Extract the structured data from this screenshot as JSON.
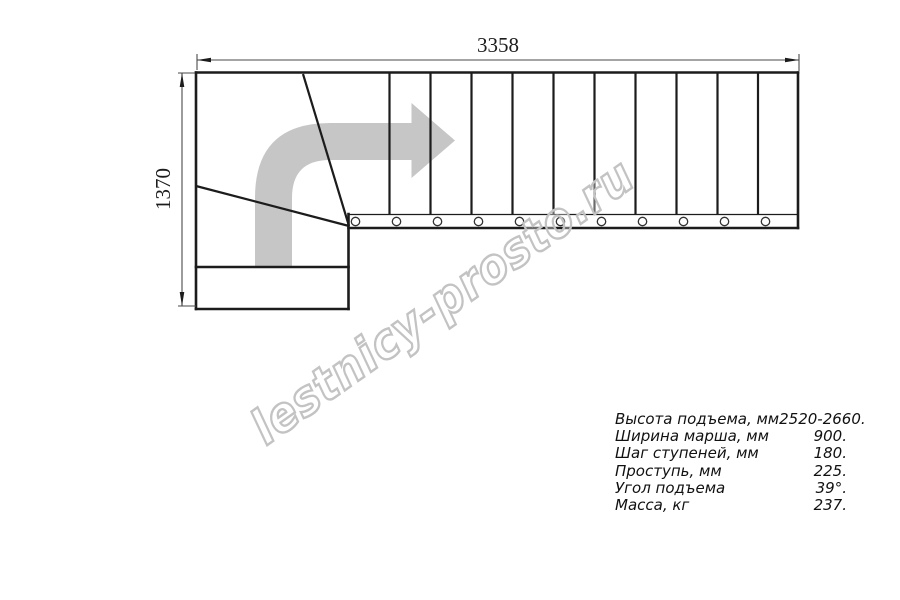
{
  "drawing": {
    "title": "stair plan top view",
    "width_dimension_mm": "3358",
    "height_dimension_mm": "1370",
    "straight_treads_count": 11,
    "mount_holes_count": 11,
    "colors": {
      "line": "#1c1c1c",
      "dimension_line": "#4a4a4a",
      "direction_arrow": "#c6c6c6",
      "watermark_outline": "#c3c3c3",
      "background": "#ffffff"
    }
  },
  "watermark": {
    "text": "lestnicy-prosto.ru"
  },
  "specs": {
    "rows": [
      {
        "label": "Высота подъема, мм",
        "value": "2520-2660."
      },
      {
        "label": "Ширина марша, мм",
        "value": "900."
      },
      {
        "label": "Шаг ступеней, мм",
        "value": "180."
      },
      {
        "label": "Проступь, мм",
        "value": "225."
      },
      {
        "label": "Угол подъема",
        "value": "39°."
      },
      {
        "label": "Масса, кг",
        "value": "237."
      }
    ]
  }
}
